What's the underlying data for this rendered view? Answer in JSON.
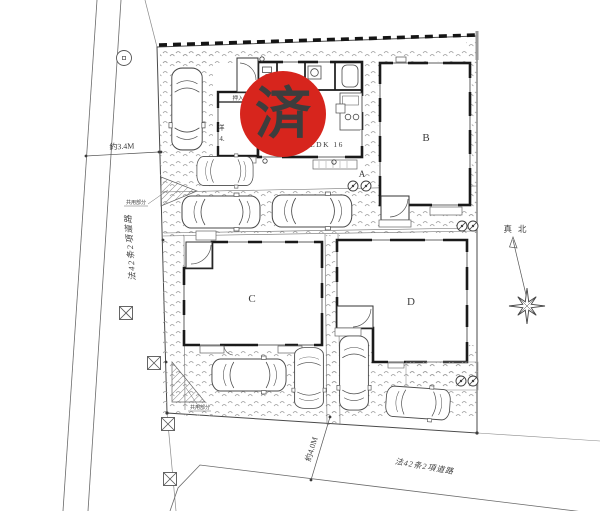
{
  "badge": {
    "text": "済",
    "color": "#d7251d"
  },
  "buildings": {
    "a": "A",
    "b": "B",
    "c": "C",
    "d": "D"
  },
  "floor_plan": {
    "ldk": "LDK 16",
    "western_room": "洋",
    "western_room_size": "4.",
    "closet": "押入"
  },
  "dimensions": {
    "left_road": "約3.4M",
    "bottom_road": "約4.0M"
  },
  "roads": {
    "left": "法42条2項道路",
    "bottom": "法42条2項道路"
  },
  "compass": {
    "true_north": "真北"
  },
  "notes": {
    "common_upper": "共用部分",
    "common_lower": "共用部分"
  }
}
